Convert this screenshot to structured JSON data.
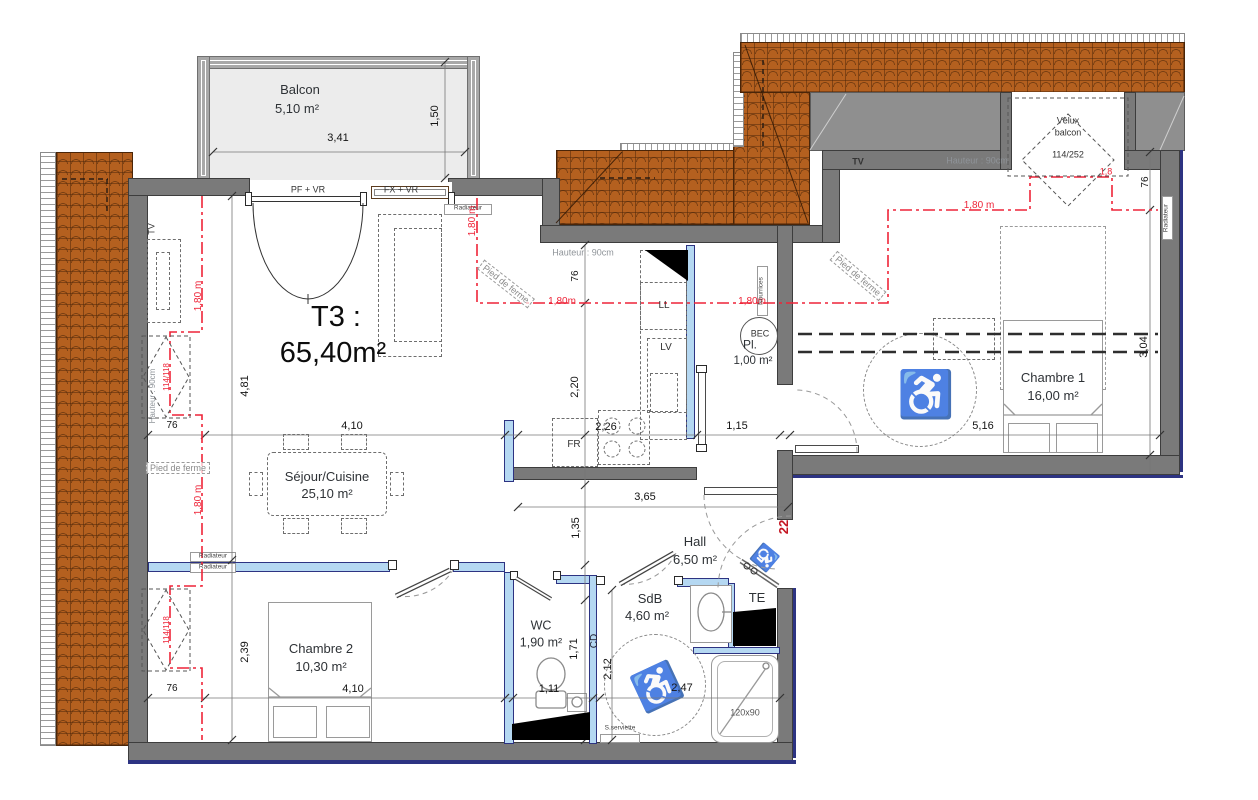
{
  "title": {
    "line1": "T3 :",
    "line2": "65,40m²"
  },
  "rooms": {
    "balcon": {
      "name": "Balcon",
      "area": "5,10 m²"
    },
    "sejour": {
      "name": "Séjour/Cuisine",
      "area": "25,10 m²"
    },
    "chambre1": {
      "name": "Chambre 1",
      "area": "16,00 m²"
    },
    "chambre2": {
      "name": "Chambre 2",
      "area": "10,30 m²"
    },
    "hall": {
      "name": "Hall",
      "area": "6,50 m²"
    },
    "wc": {
      "name": "WC",
      "area": "1,90 m²"
    },
    "sdb": {
      "name": "SdB",
      "area": "4,60 m²"
    },
    "placard": {
      "name": "Pl.",
      "area": "1,00 m²"
    }
  },
  "openings": {
    "window_pf": "PF + VR",
    "window_fx": "FX + VR",
    "entry_number": "22"
  },
  "velux": {
    "name_line1": "Vélux",
    "name_line2": "balcon",
    "size_roof": "114/252",
    "size_left": "114/118"
  },
  "equipment": {
    "ll": "LL",
    "lv": "LV",
    "fr": "FR",
    "bec": "BEC",
    "te": "TE",
    "cd": "CD",
    "tv": "TV",
    "radiateur": "Radiateur",
    "nourrices": "Nourrices",
    "shower_size": "120x90",
    "seche_serviette": "S.serviette"
  },
  "notes": {
    "hauteur": "Hauteur : 90cm",
    "pied_de_ferme": "Pied de ferme"
  },
  "dimensions": {
    "d341": "3,41",
    "d150": "1,50",
    "d481": "4,81",
    "d76": "76",
    "d410": "4,10",
    "d220": "2,20",
    "d226": "2,26",
    "d115": "1,15",
    "d516": "5,16",
    "d304": "3,04",
    "d365": "3,65",
    "d135": "1,35",
    "d239": "2,39",
    "d111": "1,11",
    "d171": "1,71",
    "d212": "2,12",
    "d247": "2,47"
  },
  "red_heights": {
    "m180_full": "1,80 m",
    "m180": "1,80m",
    "m18": "1,8"
  },
  "colors": {
    "wall": "#7a7a7a",
    "partition": "#b5d8f2",
    "roof": "#b35c1e",
    "accent_red": "#ee2438",
    "outline": "#2d3382"
  }
}
